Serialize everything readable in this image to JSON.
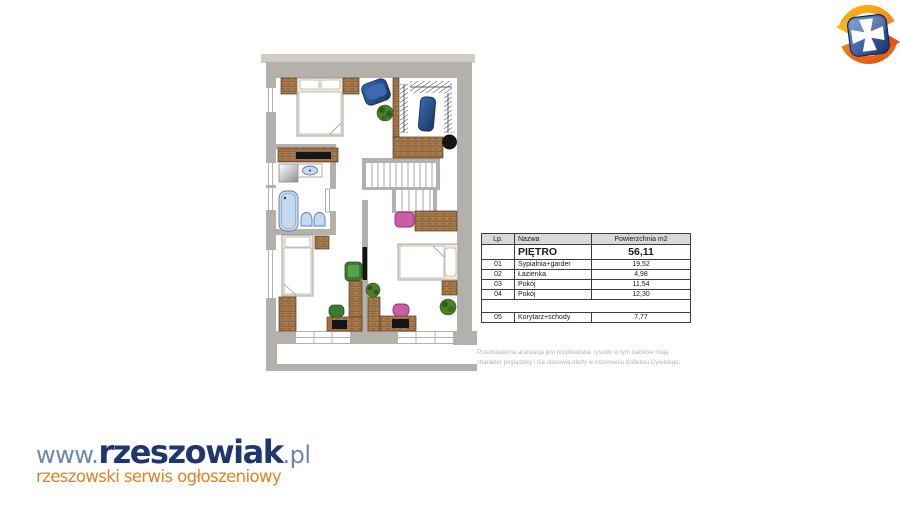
{
  "theme": {
    "wall": "#b4b0ac",
    "wall-light": "#cfccc8",
    "wood": "#a87c50",
    "wood-dark": "#82582e",
    "navy": "#2a4d85",
    "navy-dark": "#1b3560",
    "aqua": "#c7d9ee",
    "aqua-edge": "#5b7cb0",
    "pink": "#c95da6",
    "pink-edge": "#8e3470",
    "green": "#3c7a33",
    "plant": "#4c7f2c",
    "cream": "#f2e9d6",
    "logo-navy": "#21366e",
    "logo-blue": "#6d86ac",
    "logo-orange": "#e8801f",
    "table-border": "#3c3c3c",
    "table-header-bg": "#d9d9d9",
    "disclaimer-gray": "#b5b5b5",
    "emblem-orange": "#f08318",
    "emblem-blue": "#16306b"
  },
  "site_logo": {
    "www": "www.",
    "name": "rzeszowiak",
    "tld": ".pl",
    "tagline": "rzeszowski serwis ogłoszeniowy"
  },
  "area_table": {
    "columns": [
      "Lp.",
      "Nazwa",
      "Powierzchnia m2"
    ],
    "floor": {
      "lp": "",
      "name": "PIĘTRO",
      "area": "56,11"
    },
    "rows": [
      {
        "lp": "01",
        "name": "Sypialnia+garder",
        "area": "19,52"
      },
      {
        "lp": "02",
        "name": "Łazienka",
        "area": "4,98"
      },
      {
        "lp": "03",
        "name": "Pokój",
        "area": "11,54"
      },
      {
        "lp": "04",
        "name": "Pokój",
        "area": "12,30"
      },
      {
        "lp": "05",
        "name": "Korytarz+schody",
        "area": "7,77"
      }
    ]
  },
  "disclaimer": {
    "line1": "Przedstawiona aranżacja jest przykładowa, rysunki w tym zakresie mają",
    "line2": "charakter poglądowy i nie stanowią oferty w rozumieniu Kodeksu Cywilnego."
  }
}
